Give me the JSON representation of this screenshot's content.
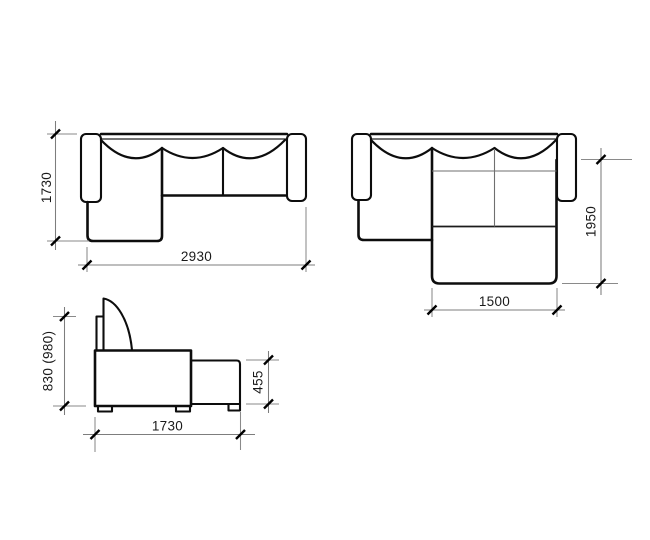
{
  "page": {
    "background": "#ffffff"
  },
  "drawing": {
    "type": "furniture-dimension-diagram",
    "subject": "corner-sofa-bed-three-views",
    "colors": {
      "outline": "#0d0d0d",
      "dimension_line": "#7d7d7d",
      "text": "#1a1a1a"
    },
    "views": {
      "plan_folded": {
        "depth": "1730",
        "width": "2930"
      },
      "plan_unfolded": {
        "bed_length": "1950",
        "bed_width": "1500"
      },
      "side": {
        "height": "830 (980)",
        "ottoman_height": "455",
        "depth": "1730"
      }
    }
  }
}
